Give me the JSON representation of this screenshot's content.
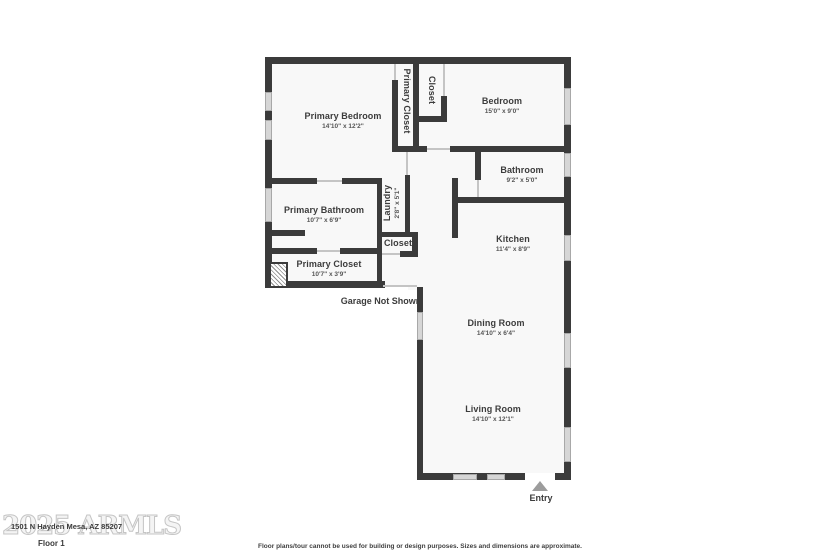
{
  "colors": {
    "wall": "#3b3b3b",
    "floor": "#f8f8f8",
    "window": "#d6d6d6",
    "door_line": "#c4c4c4",
    "text": "#3c3c3c",
    "entry_arrow": "#9c9c9c",
    "watermark": "#c5c5c5"
  },
  "rooms": {
    "primary_bedroom": {
      "name": "Primary Bedroom",
      "dims": "14'10\" x 12'2\""
    },
    "bedroom": {
      "name": "Bedroom",
      "dims": "15'0\" x 9'0\""
    },
    "bathroom": {
      "name": "Bathroom",
      "dims": "9'2\" x 5'0\""
    },
    "primary_bathroom": {
      "name": "Primary Bathroom",
      "dims": "10'7\" x 6'9\""
    },
    "primary_closet_strip": {
      "name": "Primary Closet"
    },
    "bedroom_closet": {
      "name": "Closet"
    },
    "laundry": {
      "name": "Laundry",
      "dims": "2'8\" x 5'1\""
    },
    "hall_closet": {
      "name": "Closet"
    },
    "primary_closet_room": {
      "name": "Primary Closet",
      "dims": "10'7\" x 3'9\""
    },
    "kitchen": {
      "name": "Kitchen",
      "dims": "11'4\" x 8'9\""
    },
    "dining_room": {
      "name": "Dining Room",
      "dims": "14'10\" x 6'4\""
    },
    "living_room": {
      "name": "Living Room",
      "dims": "14'10\" x 12'1\""
    }
  },
  "annotations": {
    "garage_note": "Garage Not Shown",
    "entry_label": "Entry"
  },
  "footer": {
    "watermark": "2025 ARMLS",
    "address": "1501 N Hayden Mesa, AZ 85207",
    "floor_label": "Floor 1",
    "disclaimer": "Floor plans/tour cannot be used for building or design purposes. Sizes and dimensions are approximate."
  }
}
